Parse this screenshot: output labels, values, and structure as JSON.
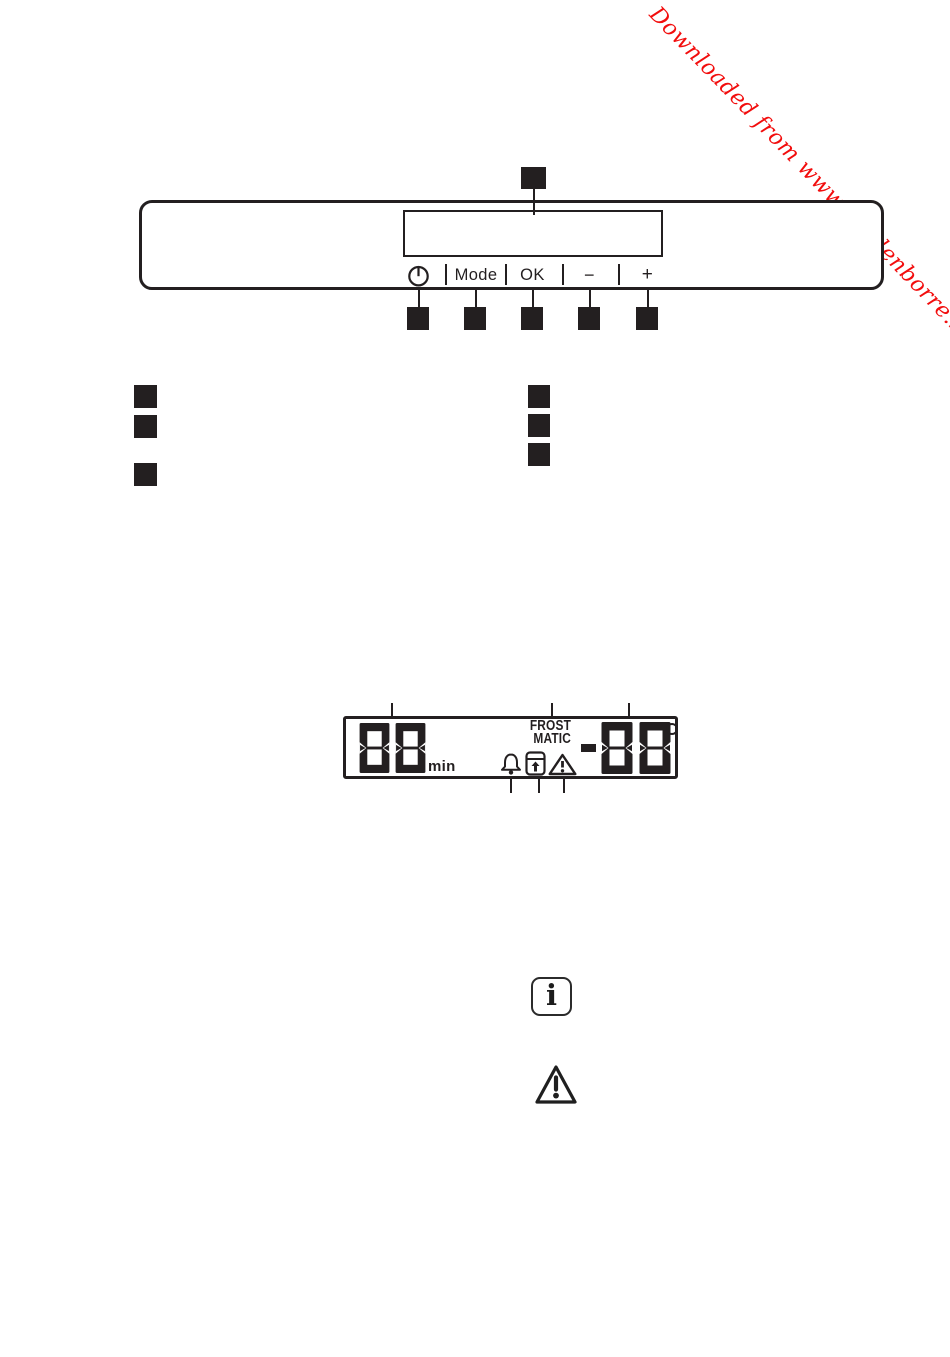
{
  "page": {
    "background": "#ffffff",
    "ink": "#231f20"
  },
  "watermark": {
    "text": "Downloaded from www.vandenborre.be",
    "color": "#f20d0d"
  },
  "control_panel_figure": {
    "buttons": {
      "power_icon": "power-icon",
      "mode": "Mode",
      "ok": "OK",
      "minus": "−",
      "plus": "+"
    },
    "callout_markers": {
      "above_display": 1,
      "below_buttons": 5
    }
  },
  "legend_markers": {
    "left_column": 3,
    "right_column": 3
  },
  "display_figure": {
    "timer_value": "88",
    "timer_unit": "min",
    "frostmatic_line1": "FROST",
    "frostmatic_line2": "MATIC",
    "temperature_value": "-88",
    "degree_symbol": "°",
    "status_icons": [
      "alarm-bell",
      "child-lock",
      "warning-triangle"
    ]
  },
  "info_note_symbol": "i",
  "warning_note_symbol": "!"
}
